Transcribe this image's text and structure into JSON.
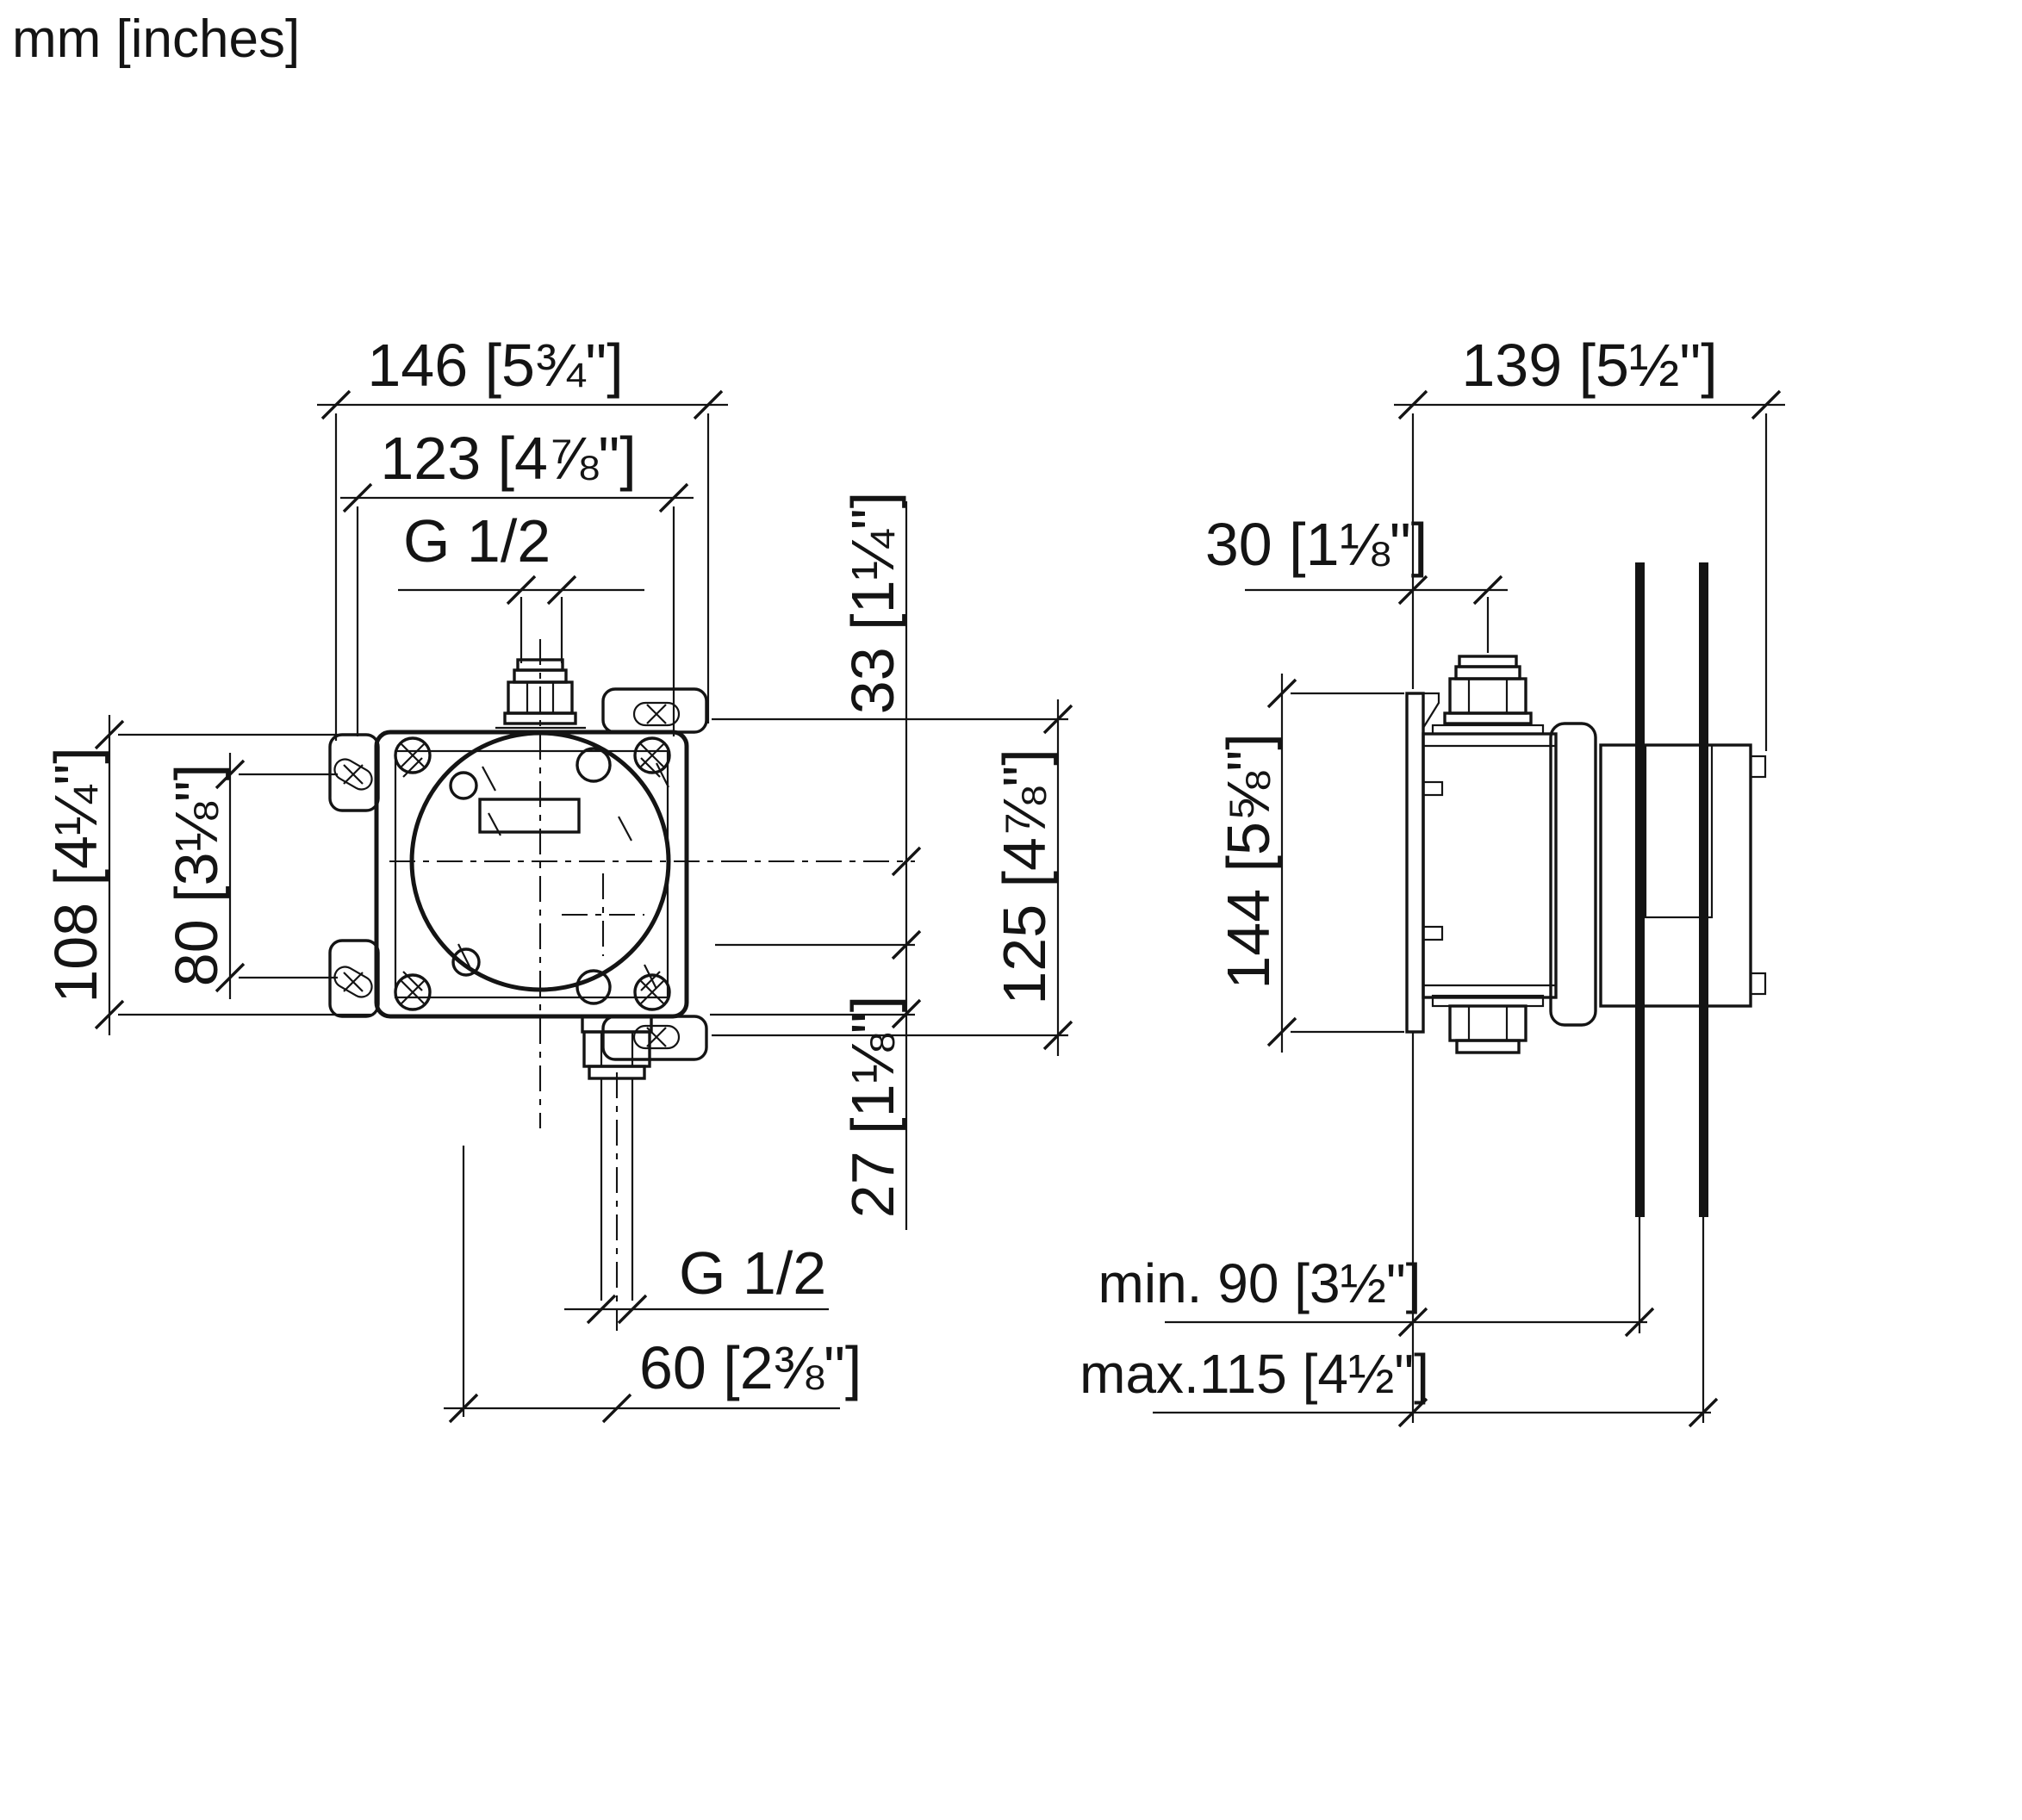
{
  "title": {
    "units_note": "mm [inches]"
  },
  "front_view": {
    "description": "front elevation of concealed valve rough-in body",
    "dims": {
      "width_overall": "146 [5¾\"]",
      "width_body": "123 [4⅞\"]",
      "thread_top": "G 1/2",
      "height_overall": "108 [4¼\"]",
      "mount_hole_spacing": "80 [3⅛\"]",
      "top_offset": "33 [1¼\"]",
      "body_height": "125 [4⅞\"]",
      "bottom_offset": "27 [1⅛\"]",
      "thread_bottom": "G 1/2",
      "outlet_offset": "60 [2⅜\"]"
    }
  },
  "side_view": {
    "description": "side elevation with wall installation depth",
    "dims": {
      "depth_overall": "139 [5½\"]",
      "connection_projection": "30 [1⅛\"]",
      "plate_height": "144 [5⅝\"]",
      "install_depth_min": "min. 90 [3½\"]",
      "install_depth_max": "max.115 [4½\"]"
    }
  }
}
